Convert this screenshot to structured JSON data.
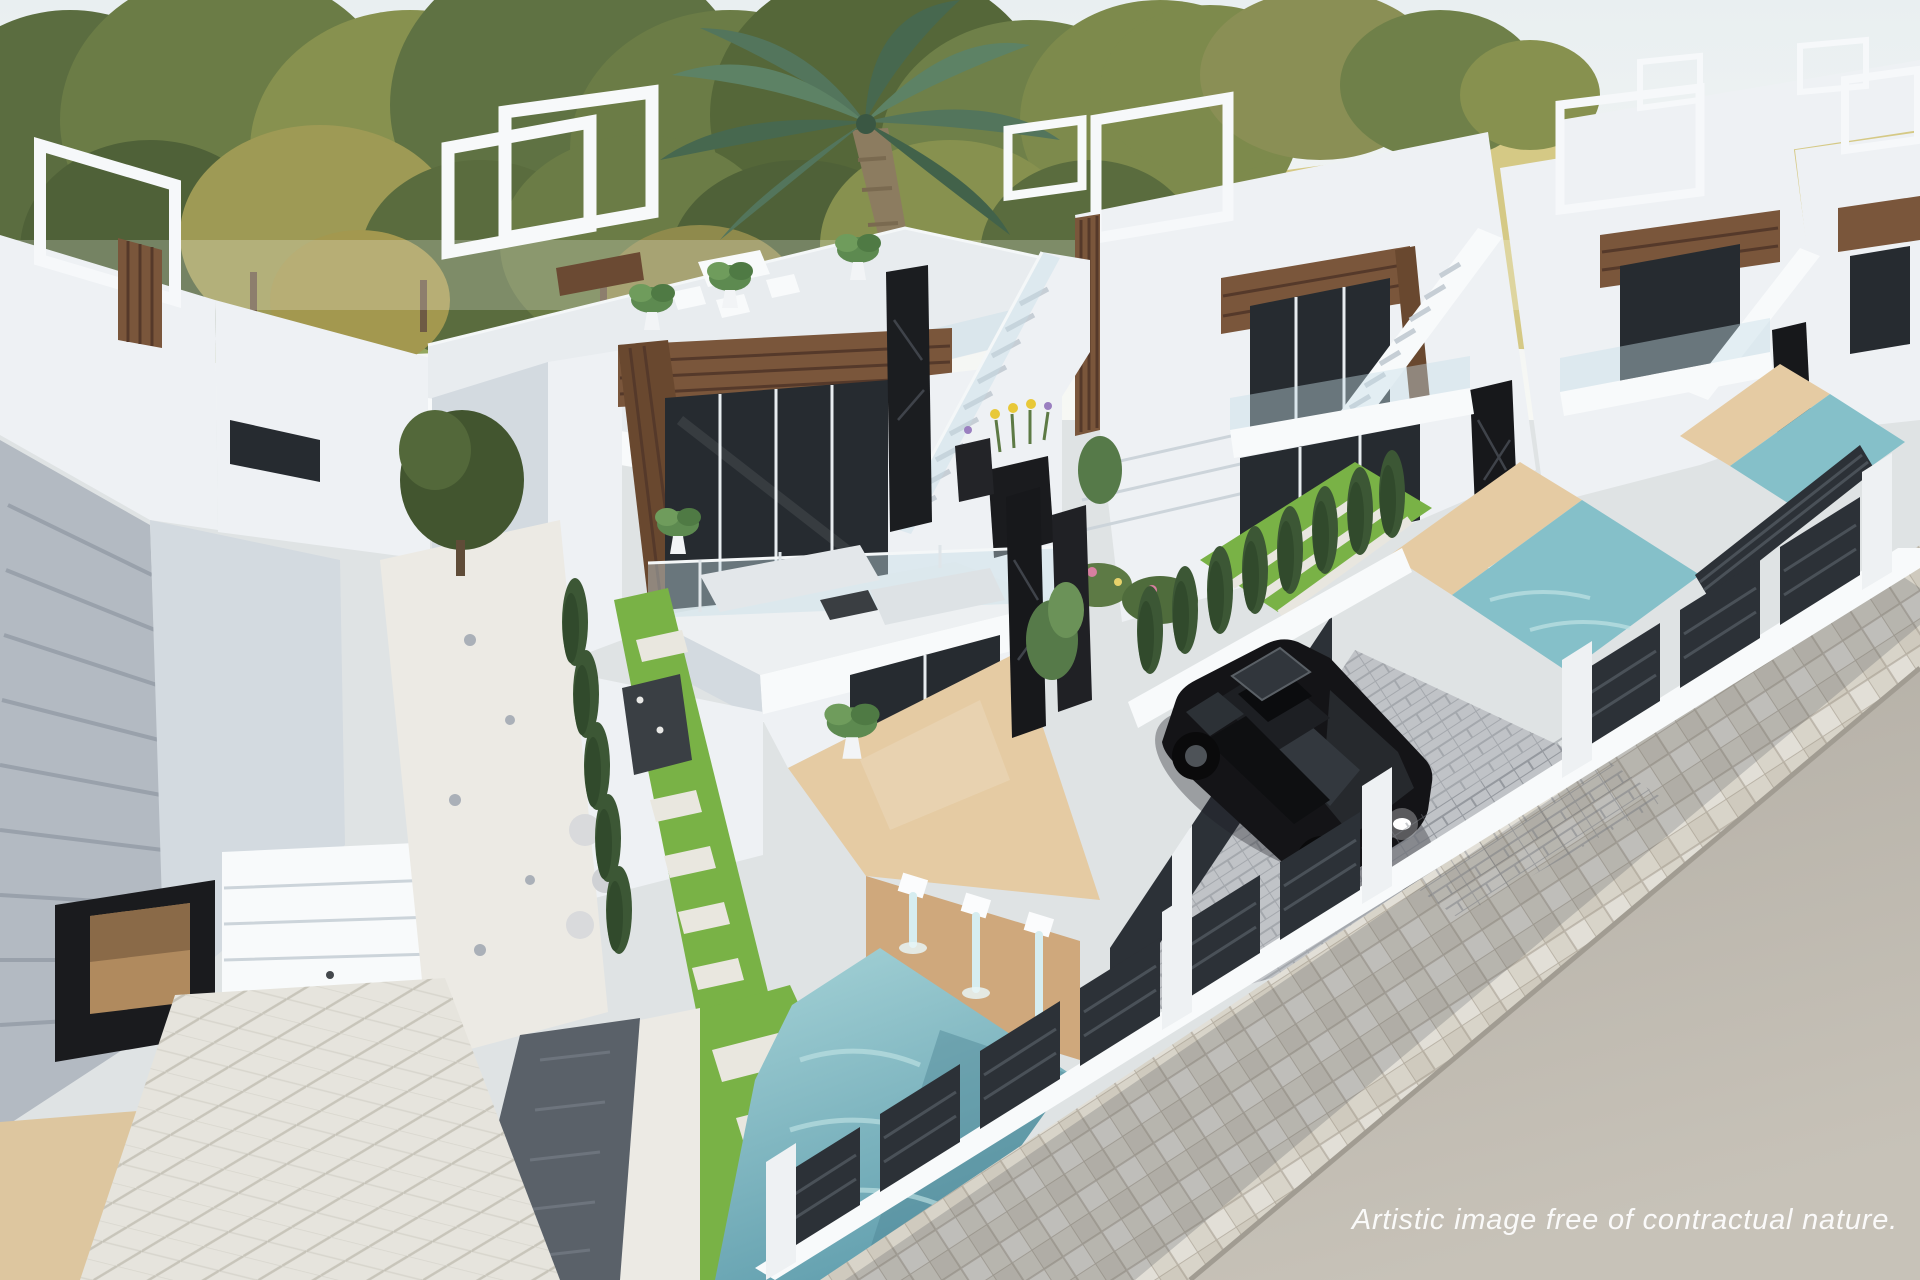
{
  "scene": {
    "type": "architectural-3d-rendering",
    "description": "Aerial artist's impression of a row of modern white two-storey villas with wooden pergola accents, black marble pillars, rooftop terraces, private turquoise pools with water spouts, landscaped gardens, a parked black car and a street with tiled sidewalk in the lower right.",
    "watermark": {
      "text": "Artistic image free of contractual nature."
    },
    "key_elements": [
      "background trees",
      "yellow field horizon",
      "palm tree",
      "central villa with rooftop terrace",
      "balcony lounge furniture",
      "wood pergola frame",
      "black marble pillars",
      "exterior staircase",
      "beige sun deck with three water spouts",
      "turquoise swimming pool",
      "stepping-stone garden path",
      "cypress hedge",
      "black parked car",
      "paver driveway",
      "dark slatted boundary fences with white pillars",
      "row of identical villas receding to the right",
      "tiled sidewalk",
      "asphalt road"
    ],
    "colors": {
      "sky_top": "#e8eef0",
      "sky_horizon": "#f6f7f3",
      "field": "#d5c985",
      "meadow": "#94a75e",
      "earth": "#9a744f",
      "tree_dark": "#4f6138",
      "tree_mid": "#6b7c46",
      "tree_light": "#87914f",
      "palm_green": "#53755c",
      "wall_white": "#f3f5f7",
      "wall_bright": "#fbfcfd",
      "wall_shadow": "#ccd4da",
      "wood": "#7a563b",
      "wood_dark": "#57392a",
      "marble_black": "#17181b",
      "glass_dark": "#24292e",
      "pool_water": "#85c0c9",
      "pool_deep": "#5e9aaa",
      "deck_beige": "#e5cba3",
      "deck_shadow": "#cfa87c",
      "grass": "#79b246",
      "gravel_white": "#eceae4",
      "paver_light": "#dedbd2",
      "paver_dark": "#5a6169",
      "drive_gray": "#c0c3c7",
      "sidewalk": "#d8d4c9",
      "road": "#b6b1a8",
      "fence_dark": "#2c3137",
      "cypress": "#3c5735",
      "car_black": "#141417"
    }
  }
}
